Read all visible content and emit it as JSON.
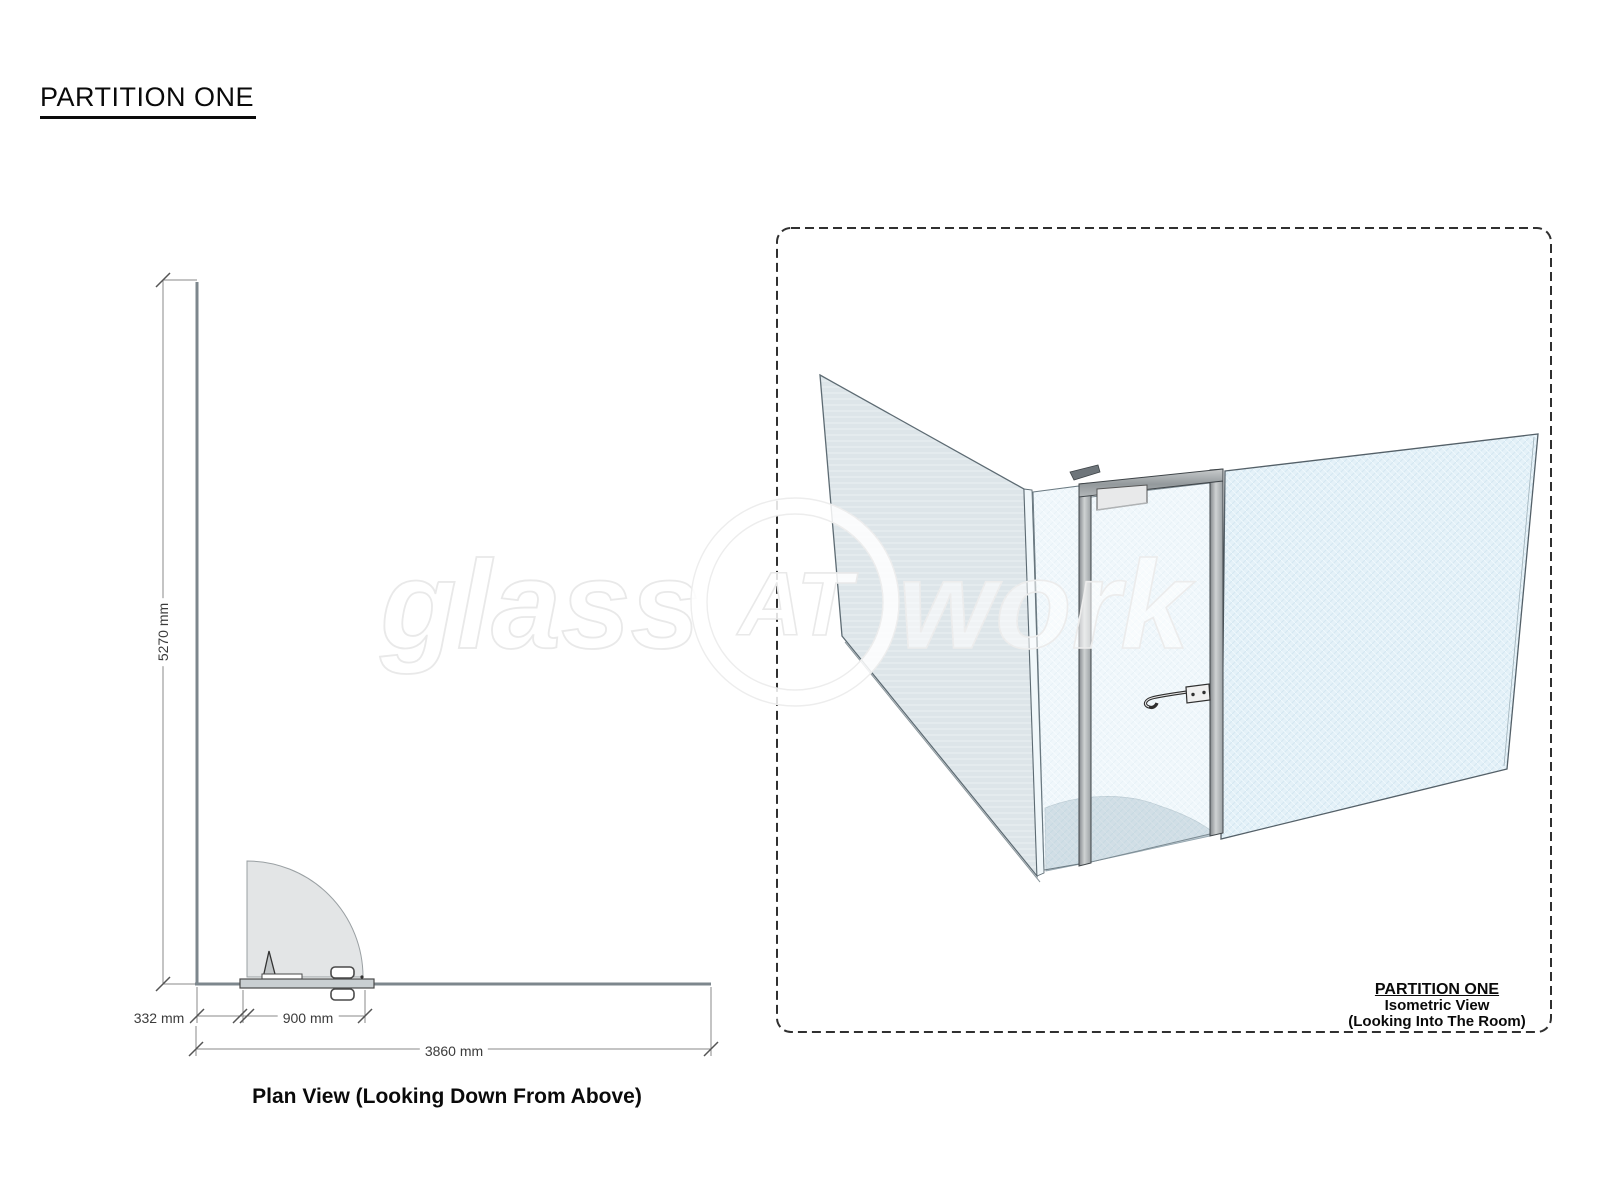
{
  "title": "PARTITION ONE",
  "plan_view": {
    "caption": "Plan View (Looking Down From Above)",
    "dimensions": {
      "height": "5270 mm",
      "left_offset": "332 mm",
      "door_width": "900 mm",
      "total_width": "3860 mm"
    }
  },
  "isometric_view": {
    "label_title": "PARTITION ONE",
    "label_line2": "Isometric View",
    "label_line3": "(Looking Into The Room)"
  },
  "watermark": {
    "part1": "glass",
    "part2": "AT",
    "part3": "work"
  },
  "colors": {
    "glass_front": "#e4f1f8",
    "glass_side": "#dde5e9",
    "frame_metal": "#a9adb0",
    "swing_shadow": "#b9c7cf",
    "wall_line": "#7d878d",
    "dimension_line": "#8a8a8a",
    "dashed_border": "#303030"
  }
}
